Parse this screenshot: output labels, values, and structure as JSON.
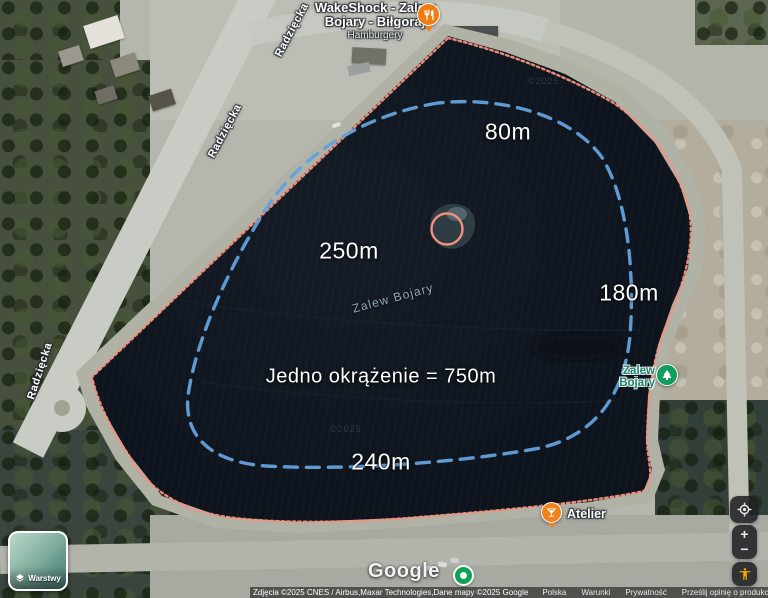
{
  "annotations": {
    "seg_top": "80m",
    "seg_left": "250m",
    "seg_right": "180m",
    "seg_bottom": "240m",
    "lap": "Jedno okrążenie = 750m"
  },
  "labels": {
    "water": "Zalew Bojary",
    "street": "Radzięcka",
    "watermark": "©2025"
  },
  "pois": {
    "wakeshock": {
      "line1": "WakeShock - Zalew",
      "line2": "Bojary - Biłgoraj",
      "sub": "Hamburgery"
    },
    "atelier": "Atelier",
    "beach_line1": "Zalew",
    "beach_line2": "Bojary"
  },
  "controls": {
    "layers": "Warstwy",
    "zoom_in": "+",
    "zoom_out": "−"
  },
  "footer": {
    "logo": "Google",
    "attribution": "Zdjęcia ©2025 CNES / Airbus,Maxar Technologies,Dane mapy ©2025 Google",
    "links": [
      "Polska",
      "Warunki",
      "Prywatność",
      "Prześlij opinię o produkcie"
    ],
    "scale": "20 m"
  },
  "colors": {
    "perimeter_route": "#f3917e",
    "lap_loop": "#64a1dc",
    "restaurant_pin": "#ef7d15",
    "nature_pin": "#119e5c",
    "water_dark": "#0e141d",
    "pegman": "#f9ab00"
  }
}
